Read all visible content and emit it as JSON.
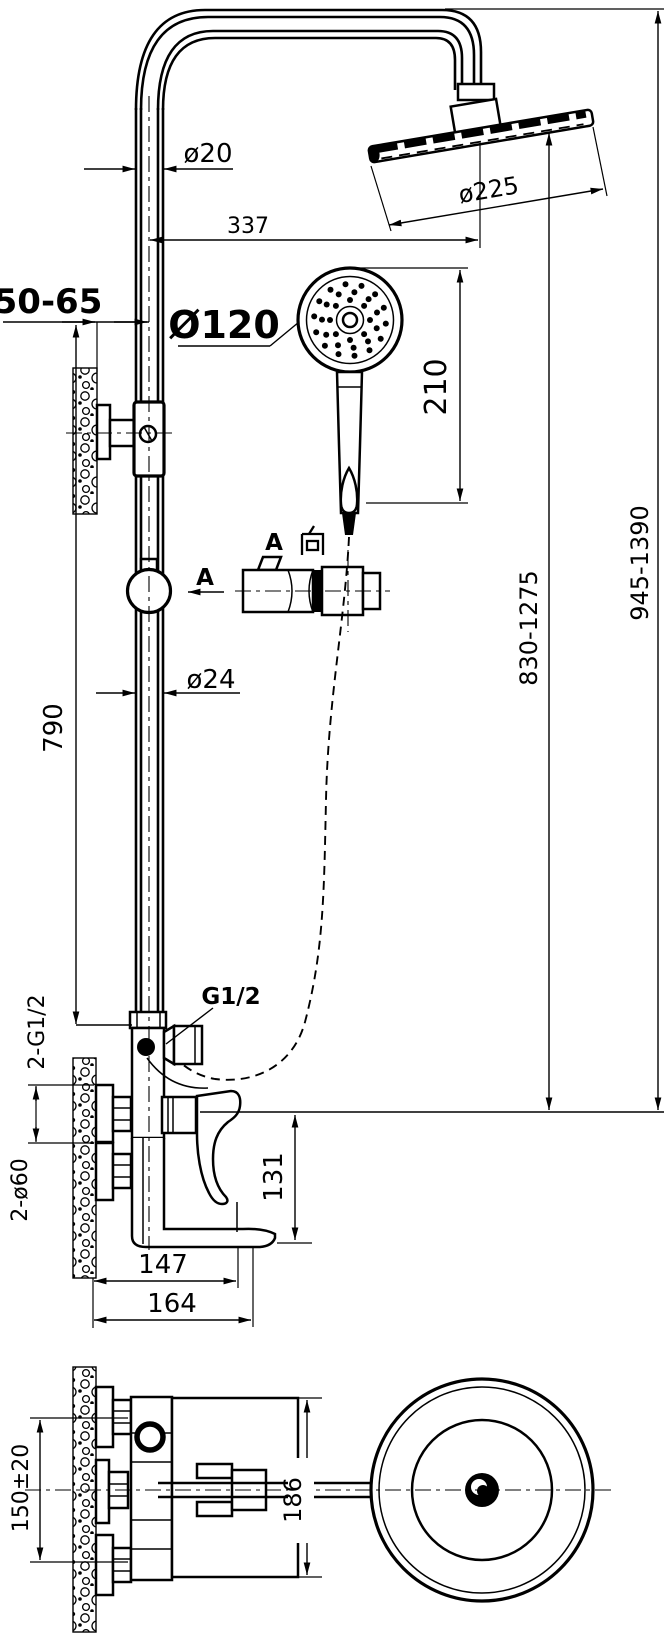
{
  "colors": {
    "ink": "#000000",
    "background": "#ffffff"
  },
  "side_view": {
    "pipe_diameter_top": "ø20",
    "arm_reach": "337",
    "head_diameter": "ø225",
    "wall_offset": "50-65",
    "overall_height_range": "945-1390",
    "head_height_range": "830-1275",
    "hand_shower_diameter": "Ø120",
    "hand_shower_length": "210",
    "view_a_full": "A 向",
    "view_a_letter": "A",
    "section_arrow": "A",
    "column_diameter": "ø24",
    "column_height": "790",
    "outlet_thread": "G1/2",
    "inlet_threads": "2-G1/2",
    "flange_diameter": "2-ø60",
    "spout_height": "131",
    "spout_reach": "147",
    "overall_reach": "164"
  },
  "plan_view": {
    "inlet_spacing": "150±20",
    "body_width": "186"
  }
}
